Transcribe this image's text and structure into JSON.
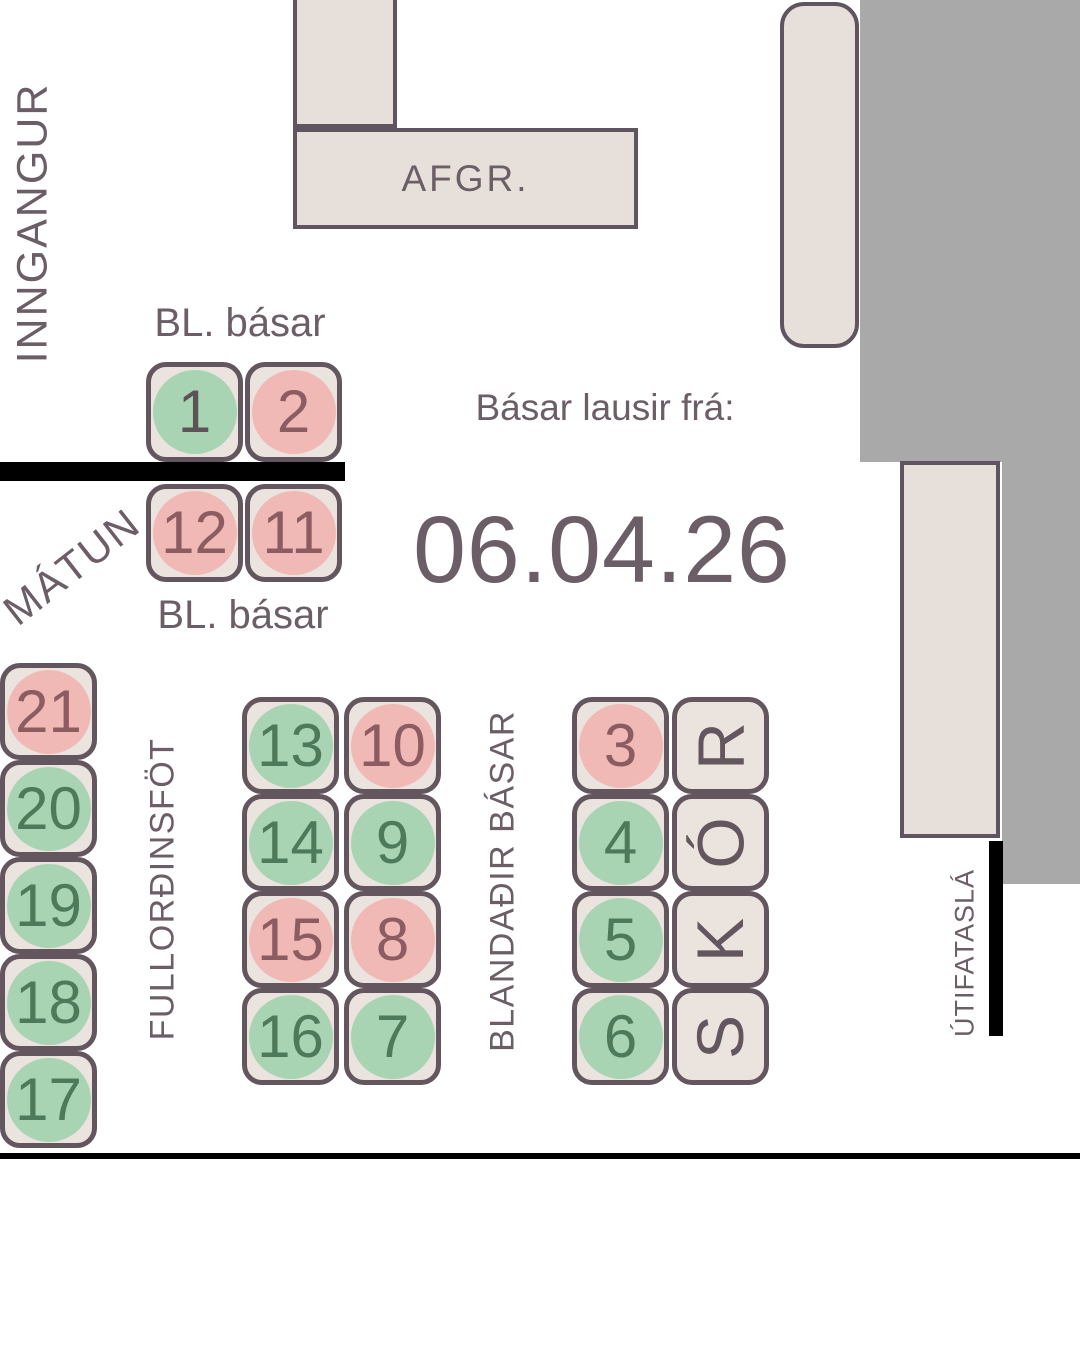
{
  "page": {
    "background": "#ffffff"
  },
  "colors": {
    "free_circle": "#a8d4b4",
    "taken_circle": "#f0b9b6",
    "tile_fill": "#eae3de",
    "tile_border": "#63565e",
    "structure_fill": "#e7dfda",
    "structure_border": "#5f5560",
    "wall_gray": "#a9a9a9",
    "text_dark": "#6b5e66",
    "num_free": "#4e7a5c",
    "num_taken": "#8d5c61",
    "num_neutral": "#5c5358",
    "bar_black": "#000000"
  },
  "labels": {
    "entrance": "INNGANGUR",
    "register": "AFGR.",
    "fitting_room": "MÁTUN",
    "bl_basar_top": "BL. básar",
    "bl_basar_bottom": "BL. básar",
    "available_from": "Básar lausir frá:",
    "available_date": "06.04.26",
    "adult_clothing": "FULLORÐINSFÖT",
    "mixed_booths": "BLANDAÐIR BÁSAR",
    "shoes": "SKÓR",
    "outdoor_rack": "ÚTIFATASLÁ"
  },
  "status_legend": {
    "free": "green circle",
    "taken": "red circle"
  },
  "booth_groups": {
    "bl_top": {
      "booths": [
        {
          "number": "1",
          "status": "free",
          "variant": "neutral-num"
        },
        {
          "number": "2",
          "status": "taken"
        }
      ]
    },
    "bl_bottom": {
      "booths": [
        {
          "number": "12",
          "status": "taken"
        },
        {
          "number": "11",
          "status": "taken"
        }
      ]
    },
    "left_column": {
      "booths": [
        {
          "number": "21",
          "status": "taken"
        },
        {
          "number": "20",
          "status": "free"
        },
        {
          "number": "19",
          "status": "free"
        },
        {
          "number": "18",
          "status": "free"
        },
        {
          "number": "17",
          "status": "free"
        }
      ]
    },
    "center_grid": {
      "booths": [
        {
          "number": "13",
          "status": "free"
        },
        {
          "number": "10",
          "status": "taken"
        },
        {
          "number": "14",
          "status": "free"
        },
        {
          "number": "9",
          "status": "free"
        },
        {
          "number": "15",
          "status": "taken"
        },
        {
          "number": "8",
          "status": "taken"
        },
        {
          "number": "16",
          "status": "free"
        },
        {
          "number": "7",
          "status": "free"
        }
      ]
    },
    "right_column": {
      "booths": [
        {
          "number": "3",
          "status": "taken"
        },
        {
          "number": "4",
          "status": "free"
        },
        {
          "number": "5",
          "status": "free"
        },
        {
          "number": "6",
          "status": "free"
        }
      ]
    },
    "skor": {
      "letters": [
        "R",
        "Ó",
        "K",
        "S"
      ]
    }
  }
}
